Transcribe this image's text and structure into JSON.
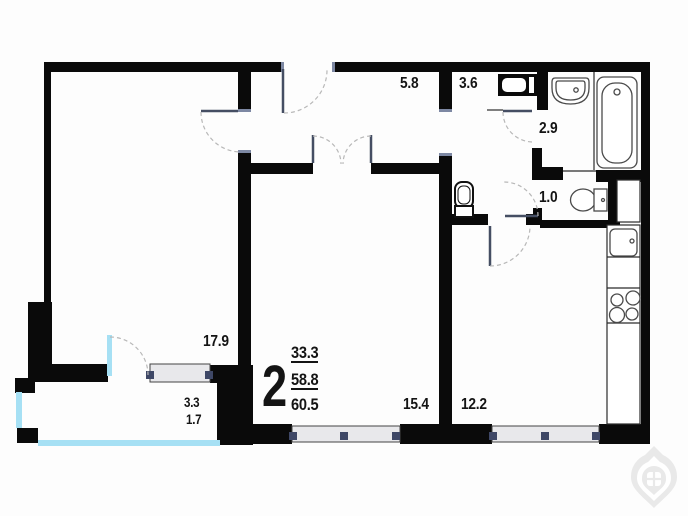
{
  "plan_summary": {
    "rooms_count": "2",
    "living_area": "33.3",
    "apartment_area": "58.8",
    "total_area": "60.5"
  },
  "room_labels": {
    "bedroom": "17.9",
    "hallway": "5.8",
    "bathroom_small": "3.6",
    "bathroom": "2.9",
    "wc": "1.0",
    "living_room": "15.4",
    "kitchen": "12.2",
    "balcony_area": "3.3",
    "balcony_area_reduced": "1.7"
  },
  "colors": {
    "wall": "#0a0a0a",
    "balcony_glazing": "#a6e0f4",
    "window_fill": "#e8e8eb",
    "window_mullion": "#3e4766",
    "door_leaf": "#454e63",
    "door_arc": "#b8b8b8",
    "fixture_outline": "#4a4a4a",
    "text": "#141414",
    "logo": "#e9e9e9"
  },
  "icons": {
    "washing_machine": "washing-machine-icon",
    "bathroom_sink": "sink-icon",
    "bathtub": "bathtub-icon",
    "toilet": "toilet-icon",
    "corridor_toilet": "toilet-icon",
    "kitchen_sink": "kitchen-sink-icon",
    "stove": "stove-burners-icon",
    "logo": "developer-logo-pin-icon"
  }
}
